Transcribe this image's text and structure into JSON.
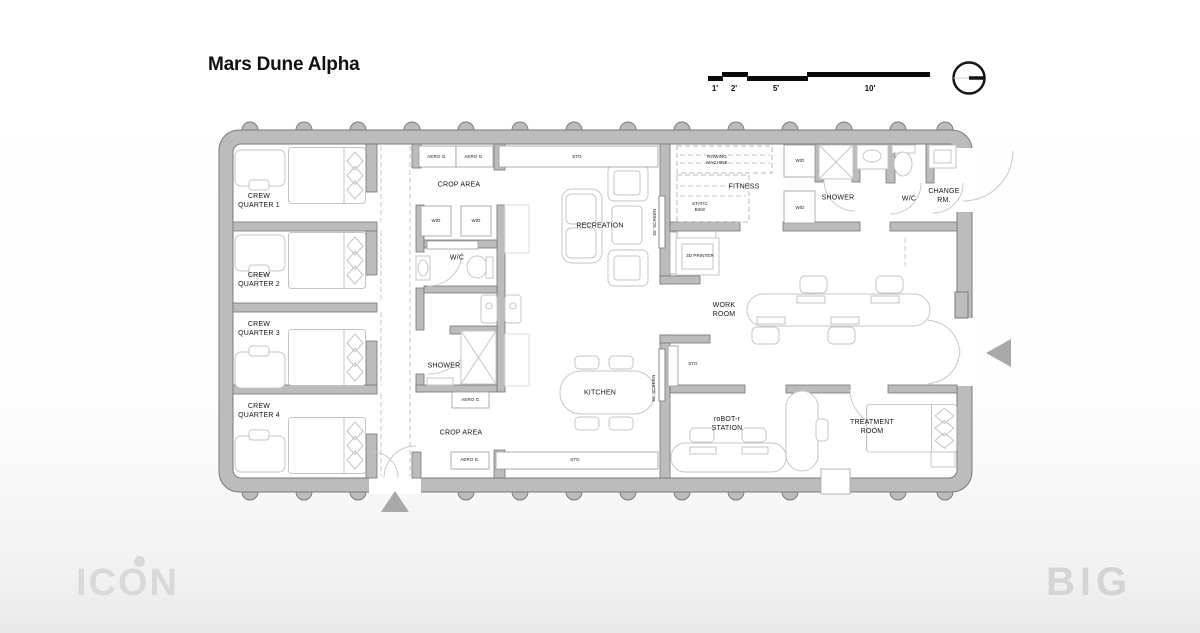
{
  "title": "Mars Dune Alpha",
  "scale_bar": {
    "ticks": [
      "1'",
      "2'",
      "5'",
      "10'"
    ]
  },
  "logos": {
    "icon": "ICON",
    "big": "BIG"
  },
  "rooms": {
    "crew1": {
      "l1": "CREW",
      "l2": "QUARTER 1"
    },
    "crew2": {
      "l1": "CREW",
      "l2": "QUARTER 2"
    },
    "crew3": {
      "l1": "CREW",
      "l2": "QUARTER 3"
    },
    "crew4": {
      "l1": "CREW",
      "l2": "QUARTER 4"
    },
    "crop_top": {
      "l1": "CROP AREA"
    },
    "crop_bottom": {
      "l1": "CROP AREA"
    },
    "recreation": {
      "l1": "RECREATION"
    },
    "fitness": {
      "l1": "FITNESS"
    },
    "kitchen": {
      "l1": "KITCHEN"
    },
    "work": {
      "l1": "WORK",
      "l2": "ROOM"
    },
    "robot": {
      "l1": "roBOT-r",
      "l2": "STATION"
    },
    "treatment": {
      "l1": "TREATMENT",
      "l2": "ROOM"
    },
    "shower_core": {
      "l1": "SHOWER"
    },
    "shower_ne": {
      "l1": "SHOWER"
    },
    "wc_core": {
      "l1": "W/C"
    },
    "wc_ne": {
      "l1": "W/C"
    },
    "change": {
      "l1": "CHANGE",
      "l2": "RM."
    }
  },
  "equipment": {
    "aero_g": "AERO G.",
    "stg": "STG",
    "wd": "W/D",
    "screen": "55' SCREEN",
    "rowing": {
      "l1": "ROWING",
      "l2": "MACHINE"
    },
    "bike": {
      "l1": "STATIC",
      "l2": "BIKE"
    },
    "printer": "3D PRINTER"
  },
  "colors": {
    "wall": "#bcbcbc",
    "wall_outline": "#767676",
    "furniture": "#c6c6c6",
    "door": "#c9c9c9",
    "marker": "#a9a9a9",
    "text": "#161616",
    "scalebar_black": "#0a0a0a",
    "logo_gray": "#d9d9d9"
  }
}
